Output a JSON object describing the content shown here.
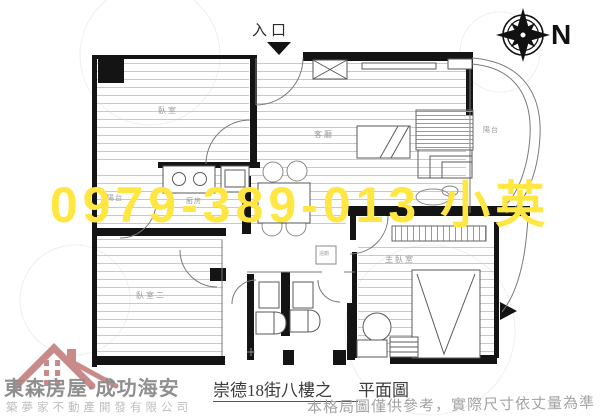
{
  "plan": {
    "entrance_label": "入口",
    "compass_n": "N",
    "rooms": {
      "bedroom1": "臥室",
      "living": "客廳",
      "kitchen": "廚房",
      "balcony_left": "陽台",
      "balcony_right": "陽台",
      "bedroom2": "臥室二",
      "master_bedroom": "主臥室",
      "bathroom": "浴廁"
    }
  },
  "watermark": {
    "text": "0979-389-013 小英",
    "color": "#ffe640"
  },
  "footer": {
    "brand": "東森房屋·成功海安",
    "company": "築夢家不動產開發有限公司",
    "plan_title_prefix": "崇德18街八樓之",
    "plan_title_suffix": "平面圖",
    "disclaimer": "本格局圖僅供參考，實際尺寸依丈量為準"
  }
}
